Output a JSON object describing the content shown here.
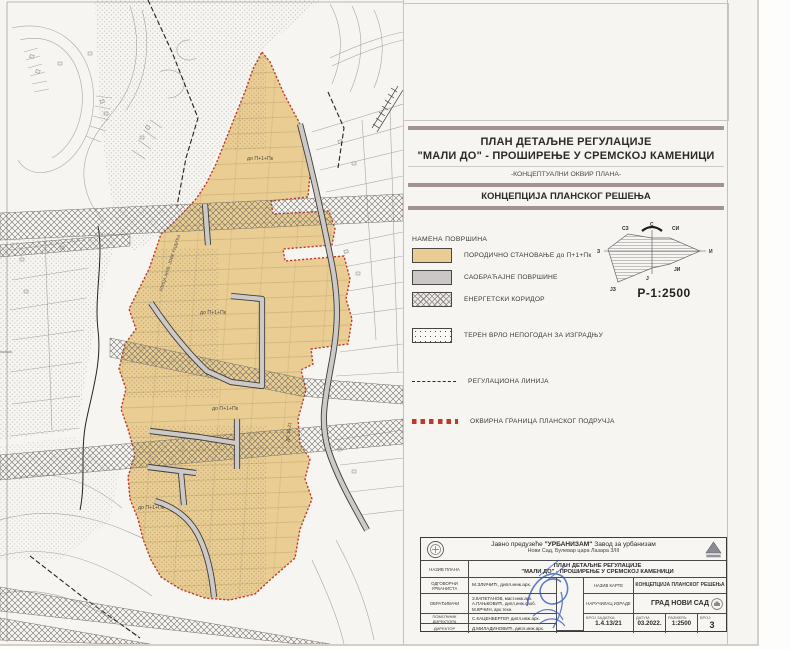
{
  "document": {
    "plan_title_line1": "ПЛАН ДЕТАЉНЕ РЕГУЛАЦИЈЕ",
    "plan_title_line2": "\"МАЛИ ДО\" - ПРОШИРЕЊЕ У СРЕМСКОЈ КАМЕНИЦИ",
    "subtitle": "-КОНЦЕПТУАЛНИ ОКВИР ПЛАНА-",
    "map_title": "КОНЦЕПЦИЈА ПЛАНСКОГ РЕШЕЊА"
  },
  "legend": {
    "heading": "НАМЕНА ПОВРШИНА",
    "items": [
      {
        "label": "ПОРОДИЧНО СТАНОВАЊЕ до П+1+Пк",
        "swatch": "family-housing",
        "color": "#eacd92"
      },
      {
        "label": "САОБРАЋАЈНЕ ПОВРШИНЕ",
        "swatch": "traffic-surfaces",
        "color": "#cbc7c6"
      },
      {
        "label": "ЕНЕРГЕТСКИ КОРИДОР",
        "swatch": "energy-corridor"
      },
      {
        "label": "ТЕРЕН ВРЛО НЕПОГОДАН ЗА ИЗГРАДЊУ",
        "swatch": "unsuitable-terrain"
      },
      {
        "label": "РЕГУЛАЦИОНА ЛИНИЈА",
        "swatch": "regulation-line"
      },
      {
        "label": "ОКВИРНА ГРАНИЦА ПЛАНСКОГ ПОДРУЧЈА",
        "swatch": "plan-boundary",
        "color": "#c0392b"
      }
    ]
  },
  "compass": {
    "n": "С",
    "nw": "СЗ",
    "ne": "СИ",
    "w": "З",
    "e": "И",
    "sw": "ЈЗ",
    "se": "ЈИ",
    "s": "Ј",
    "scale": "Р-1:2500"
  },
  "map": {
    "zone_labels": [
      "до П+1+Пк",
      "до П+1+Пк",
      "до П+1+Пк",
      "до П+1+Пк"
    ],
    "street_label": "УЛИЦА ЖИВ. ЈОВЕ РАДИЋА",
    "road_label": "ДП 16-21"
  },
  "title_block": {
    "company_prefix": "Јавно предузеће ",
    "company_name": "\"УРБАНИЗАМ\"",
    "company_suffix": " Завод за урбанизам",
    "company_address": "Нови Сад, Булевар цара Лазара 3/III",
    "plan_name_label": "НАЗИВ ПЛАНА",
    "plan_name_line1": "ПЛАН ДЕТАЉНЕ РЕГУЛАЦИЈЕ",
    "plan_name_line2": "\"МАЛИ ДО\" - ПРОШИРЕЊЕ У СРЕМСКОЈ КАМЕНИЦИ",
    "urbanist_label": "ОДГОВОРНИ УРБАНИСТА",
    "urbanist": "М.ЗЛИЧИЋ, дипл.инж.арх.",
    "authors_label": "ОБРАЂИВАЧИ",
    "author1": "З.КАПЕТАНОВ, маст.инж.арх.",
    "author2": "А.ПАЊКОВИЋ, дипл.инж.саоб.",
    "author3": "М.КРЧИН, арх.техн.",
    "deputy_label": "ПОМОЋНИК ДИРЕКТОРА",
    "deputy": "С.КАЦЕНБЕРГЕР, дипл.инж.арх.",
    "director_label": "ДИРЕКТОР",
    "director": "Д.МИЛАДИНОВИЋ, дипл.инж.арх.",
    "map_name_label": "НАЗИВ КАРТЕ",
    "map_name": "КОНЦЕПЦИЈА ПЛАНСКОГ РЕШЕЊА",
    "client_label": "НАРУЧИЛАЦ ИЗРАДЕ",
    "client": "ГРАД НОВИ САД",
    "task_label": "БРОЈ ЗАДАТКА:",
    "task_number": "1.4.13/21",
    "date_label": "ДАТУМ:",
    "date": "03.2022.",
    "scale_label": "РАЗМЕРА:",
    "scale": "1:2500",
    "sheet_label": "БРОЈ:",
    "sheet_number": "3"
  }
}
